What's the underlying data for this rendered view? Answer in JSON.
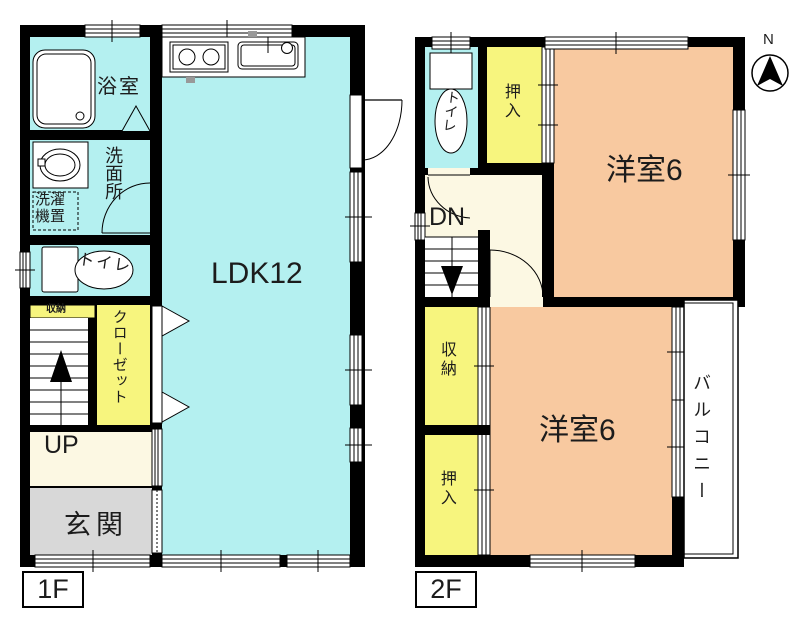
{
  "legend": {
    "floor1": "1F",
    "floor2": "2F"
  },
  "compass": {
    "north": "N"
  },
  "colors": {
    "room_cyan": "#b4f0f0",
    "room_yellow": "#f7f57e",
    "room_cream": "#fcf8e3",
    "room_gray": "#d8d8d8",
    "room_peach": "#f8c9a0",
    "wall": "#000000"
  },
  "floor1": {
    "bath": "浴室",
    "washroom": "洗面所",
    "laundry": "洗濯\n機置",
    "toilet": "トイレ",
    "storage": "収納",
    "closet": "クローゼット",
    "stairs_dir": "UP",
    "entrance": "玄関",
    "ldk": "LDK12"
  },
  "floor2": {
    "toilet": "トイレ",
    "oshiire_upper": "押入",
    "bedroom_upper": "洋室6",
    "stairs_dir": "DN",
    "storage": "収納",
    "oshiire_lower": "押入",
    "bedroom_lower": "洋室6",
    "balcony": "バルコニー"
  }
}
